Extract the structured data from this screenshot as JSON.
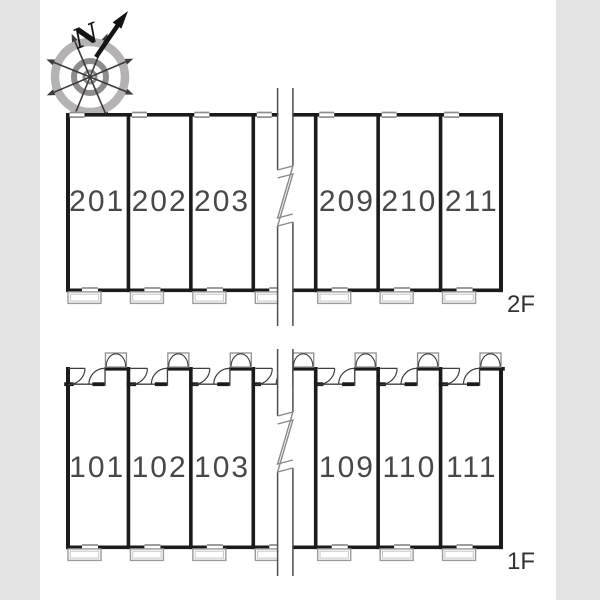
{
  "compass": {
    "north_label": "N"
  },
  "floors": [
    {
      "label": "2F",
      "rooms_left": [
        "201",
        "202",
        "203"
      ],
      "rooms_right": [
        "209",
        "210",
        "211"
      ]
    },
    {
      "label": "1F",
      "rooms_left": [
        "101",
        "102",
        "103"
      ],
      "rooms_right": [
        "109",
        "110",
        "111"
      ]
    }
  ],
  "symbols": {
    "break_line": "section-break-zigzag",
    "window": "sliding-window",
    "balcony": "balcony-step",
    "entry_door": "door-swing-arc",
    "meter_box": "double-door-meter-box"
  },
  "colors": {
    "bg": "#ffffff",
    "band": "#e5e4e4",
    "wall": "#1b1b1b",
    "thin_line": "#3d3d3d",
    "window_gray": "#8e8e8e",
    "balcony_gray": "#9b9b9b",
    "balcony_gray_light": "#c6c6c6",
    "break_line": "#4f4f4f",
    "bolt_line": "#8a8a8a",
    "room_text": "#484848",
    "floor_label_text": "#333333",
    "ring_outer": "#b4b2b2",
    "ring_inner": "#8e8c8c",
    "rose_arrow": "#3d3b3b",
    "north": "#141414"
  }
}
